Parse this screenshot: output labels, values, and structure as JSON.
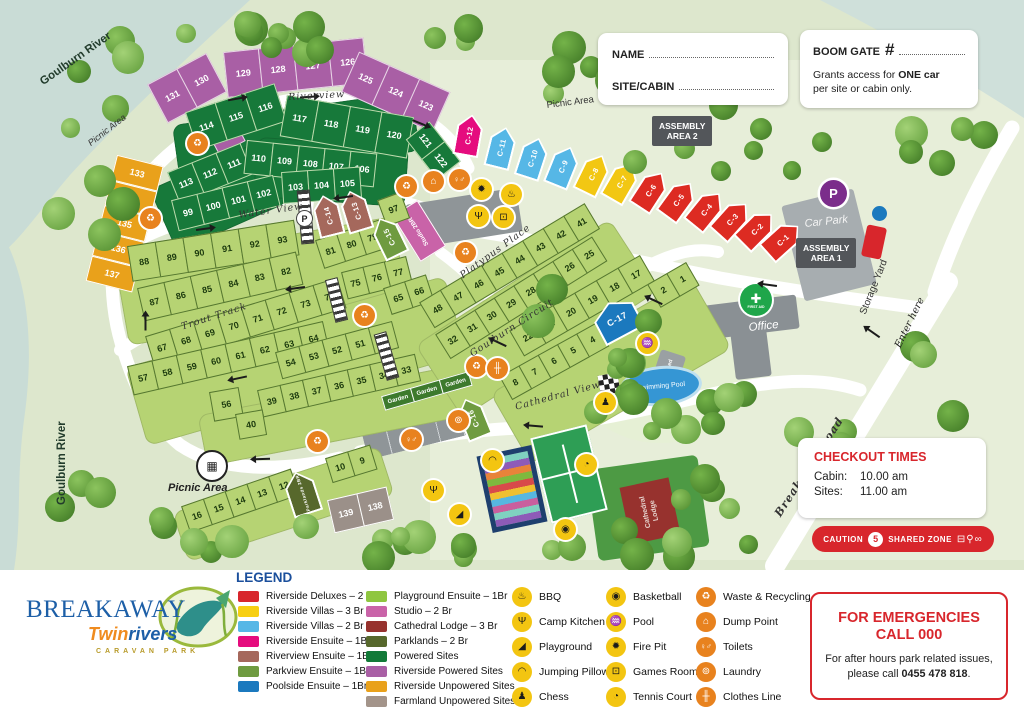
{
  "map": {
    "palette": {
      "lg": {
        "bg": "#b6d373",
        "fg": "#1c3a0e",
        "bd": "#55772f"
      },
      "dg": {
        "bg": "#17793a",
        "fg": "#ffffff",
        "bd": "#bfdcae"
      },
      "pu": {
        "bg": "#a95fa5",
        "fg": "#ffffff",
        "bd": "#e9d7e7"
      },
      "or": {
        "bg": "#e9a11b",
        "fg": "#ffffff",
        "bd": "#ffffff"
      },
      "gy": {
        "bg": "#9b9089",
        "fg": "#ffffff",
        "bd": "#ffffff"
      },
      "gn": {
        "bg": "#3d7a2d",
        "fg": "#ffffff",
        "bd": "#ffffff"
      }
    },
    "labels": {
      "goulburn_river": "Goulburn River",
      "picnic_area": "Picnic Area",
      "assembly": "ASSEMBLY",
      "area1": "AREA 1",
      "area2": "AREA 2",
      "car_park": "Car Park",
      "storage_yard": "Storage Yard",
      "office": "Office",
      "first_aid": "FIRST AID",
      "enter_here": "Enter here",
      "pump_shed": "Pump Shed",
      "swimming_pool": "Swimming Pool",
      "cathedral_1": "Cathedral",
      "cathedral_2": "Lodge",
      "studio": "Studio 2BR",
      "p": "P"
    },
    "streets": {
      "riverview": "Riverview",
      "water_view": "Water View",
      "trout_track": "Trout Track",
      "goulburn_circuit": "Goulburn Circuit",
      "cathedral_view": "Cathedral View",
      "platypus_place": "Platypus Place",
      "breakaway_road": "Breakaway Road"
    },
    "strips": [
      {
        "id": "p1",
        "x": 148,
        "y": 84,
        "rot": -28,
        "cw": 34,
        "ch": 44,
        "k": "pu",
        "nums": [
          131,
          130
        ]
      },
      {
        "id": "p2",
        "x": 224,
        "y": 52,
        "rot": -6,
        "cw": 36,
        "ch": 46,
        "k": "pu",
        "nums": [
          129,
          128,
          127,
          126
        ]
      },
      {
        "id": "p3",
        "x": 360,
        "y": 52,
        "rot": 24,
        "cw": 34,
        "ch": 44,
        "k": "pu",
        "nums": [
          125,
          124,
          123
        ]
      },
      {
        "id": "p4",
        "x": 206,
        "y": 128,
        "rot": -28,
        "cw": 30,
        "ch": 30,
        "k": "pu",
        "nums": [
          132
        ]
      },
      {
        "id": "g1",
        "x": 186,
        "y": 112,
        "rot": -18,
        "cw": 32,
        "ch": 40,
        "k": "dg",
        "nums": [
          114,
          115,
          116
        ]
      },
      {
        "id": "g2",
        "x": 288,
        "y": 95,
        "rot": 10,
        "cw": 33,
        "ch": 42,
        "k": "dg",
        "nums": [
          117,
          118,
          119,
          120
        ]
      },
      {
        "id": "g3",
        "x": 430,
        "y": 122,
        "rot": 52,
        "cw": 26,
        "ch": 30,
        "k": "dg",
        "nums": [
          121,
          122
        ]
      },
      {
        "id": "g4",
        "x": 168,
        "y": 172,
        "rot": -22,
        "cw": 27,
        "ch": 34,
        "k": "dg",
        "nums": [
          113,
          112,
          111
        ]
      },
      {
        "id": "g5",
        "x": 248,
        "y": 140,
        "rot": 6,
        "cw": 27,
        "ch": 34,
        "k": "dg",
        "nums": [
          110,
          109,
          108,
          107,
          106
        ]
      },
      {
        "id": "g6",
        "x": 172,
        "y": 200,
        "rot": -14,
        "cw": 27,
        "ch": 32,
        "k": "dg",
        "nums": [
          99,
          100,
          101,
          102
        ]
      },
      {
        "id": "g7",
        "x": 282,
        "y": 172,
        "rot": -4,
        "cw": 27,
        "ch": 32,
        "k": "dg",
        "nums": [
          103,
          104,
          105
        ]
      },
      {
        "id": "o1",
        "x": 118,
        "y": 155,
        "rot": 14,
        "cw": 48,
        "ch": 26,
        "k": "or",
        "dir": "col",
        "nums": [
          133,
          134,
          135,
          136,
          137
        ]
      },
      {
        "id": "l1",
        "x": 128,
        "y": 246,
        "rot": -9,
        "cw": 29,
        "ch": 36,
        "k": "lg",
        "nums": [
          88,
          89,
          90,
          91,
          92,
          93
        ]
      },
      {
        "id": "l2",
        "x": 316,
        "y": 240,
        "rot": -18,
        "cw": 23,
        "ch": 30,
        "k": "lg",
        "nums": [
          81,
          80,
          79
        ]
      },
      {
        "id": "l3",
        "x": 378,
        "y": 200,
        "rot": -20,
        "cw": 25,
        "ch": 28,
        "k": "lg",
        "nums": [
          97
        ]
      },
      {
        "id": "l4",
        "x": 138,
        "y": 288,
        "rot": -13,
        "cw": 28,
        "ch": 34,
        "k": "lg",
        "nums": [
          87,
          86,
          85,
          84,
          83,
          82
        ]
      },
      {
        "id": "l5",
        "x": 342,
        "y": 272,
        "rot": -14,
        "cw": 23,
        "ch": 28,
        "k": "lg",
        "nums": [
          75,
          76,
          77
        ]
      },
      {
        "id": "l6",
        "x": 146,
        "y": 336,
        "rot": -17,
        "cw": 26,
        "ch": 32,
        "k": "lg",
        "nums": [
          67,
          68,
          69,
          70,
          71,
          72,
          73,
          74
        ]
      },
      {
        "id": "l7",
        "x": 384,
        "y": 288,
        "rot": -18,
        "cw": 23,
        "ch": 28,
        "k": "lg",
        "nums": [
          65,
          66
        ]
      },
      {
        "id": "l8",
        "x": 128,
        "y": 366,
        "rot": -13,
        "cw": 26,
        "ch": 30,
        "k": "lg",
        "nums": [
          57,
          58,
          59,
          60,
          61,
          62,
          63,
          64
        ]
      },
      {
        "id": "l9",
        "x": 276,
        "y": 352,
        "rot": -15,
        "cw": 25,
        "ch": 28,
        "k": "lg",
        "nums": [
          54,
          53,
          52,
          51,
          50
        ]
      },
      {
        "id": "l10",
        "x": 258,
        "y": 390,
        "rot": -13,
        "cw": 24,
        "ch": 28,
        "k": "lg",
        "nums": [
          39,
          38,
          37,
          36,
          35,
          34,
          33
        ]
      },
      {
        "id": "l11",
        "x": 210,
        "y": 392,
        "rot": -10,
        "cw": 30,
        "ch": 30,
        "k": "lg",
        "nums": [
          56
        ]
      },
      {
        "id": "l12",
        "x": 236,
        "y": 414,
        "rot": -10,
        "cw": 28,
        "ch": 26,
        "k": "lg",
        "nums": [
          40
        ]
      },
      {
        "id": "e1",
        "x": 420,
        "y": 302,
        "rot": -31,
        "cw": 25,
        "ch": 30,
        "k": "lg",
        "nums": [
          48,
          47,
          46,
          45,
          44,
          43,
          42,
          41
        ]
      },
      {
        "id": "e2",
        "x": 436,
        "y": 334,
        "rot": -32,
        "cw": 24,
        "ch": 29,
        "k": "lg",
        "nums": [
          32,
          31,
          30,
          29,
          28,
          27,
          26,
          25
        ]
      },
      {
        "id": "e3",
        "x": 510,
        "y": 330,
        "rot": -30,
        "cw": 26,
        "ch": 30,
        "k": "lg",
        "nums": [
          22,
          21,
          20,
          19,
          18,
          17
        ]
      },
      {
        "id": "e4",
        "x": 648,
        "y": 284,
        "rot": -30,
        "cw": 23,
        "ch": 27,
        "k": "lg",
        "nums": [
          2,
          1
        ]
      },
      {
        "id": "e5",
        "x": 500,
        "y": 376,
        "rot": -29,
        "cw": 23,
        "ch": 27,
        "k": "lg",
        "nums": [
          8,
          7,
          6,
          5,
          4
        ]
      },
      {
        "id": "b1",
        "x": 182,
        "y": 506,
        "rot": -19,
        "cw": 24,
        "ch": 28,
        "k": "lg",
        "nums": [
          16,
          15,
          14,
          13,
          12
        ]
      },
      {
        "id": "b2",
        "x": 326,
        "y": 458,
        "rot": -17,
        "cw": 24,
        "ch": 26,
        "k": "lg",
        "nums": [
          10,
          9
        ]
      },
      {
        "id": "f1",
        "x": 328,
        "y": 500,
        "rot": -13,
        "cw": 31,
        "ch": 34,
        "k": "gy",
        "nums": [
          139,
          138
        ]
      },
      {
        "id": "gd",
        "x": 382,
        "y": 396,
        "rot": -16,
        "cw": 31,
        "ch": 15,
        "k": "gn",
        "fs": 6,
        "nums": [
          "Garden",
          "Garden",
          "Garden"
        ]
      }
    ],
    "cabins": [
      {
        "id": "C-12",
        "x": 452,
        "y": 114,
        "rot": 10,
        "c": "#e50c7e"
      },
      {
        "id": "C-11",
        "x": 483,
        "y": 126,
        "rot": 14,
        "c": "#56b7e6"
      },
      {
        "id": "C-10",
        "x": 513,
        "y": 136,
        "rot": 18,
        "c": "#56b7e6"
      },
      {
        "id": "C-9",
        "x": 542,
        "y": 144,
        "rot": 22,
        "c": "#56b7e6"
      },
      {
        "id": "C-8",
        "x": 571,
        "y": 151,
        "rot": 26,
        "c": "#f2c713"
      },
      {
        "id": "C-7",
        "x": 598,
        "y": 158,
        "rot": 30,
        "c": "#f2c713"
      },
      {
        "id": "C-6",
        "x": 626,
        "y": 166,
        "rot": 33,
        "c": "#dd2b22"
      },
      {
        "id": "C-5",
        "x": 653,
        "y": 175,
        "rot": 36,
        "c": "#dd2b22"
      },
      {
        "id": "C-4",
        "x": 680,
        "y": 184,
        "rot": 39,
        "c": "#dd2b22"
      },
      {
        "id": "C-3",
        "x": 705,
        "y": 193,
        "rot": 42,
        "c": "#dd2b22"
      },
      {
        "id": "C-2",
        "x": 729,
        "y": 202,
        "rot": 45,
        "c": "#dd2b22"
      },
      {
        "id": "C-1",
        "x": 754,
        "y": 212,
        "rot": 48,
        "c": "#dd2b22"
      },
      {
        "id": "C-14",
        "x": 320,
        "y": 194,
        "rot": -14,
        "c": "#a5685c"
      },
      {
        "id": "C-13",
        "x": 349,
        "y": 189,
        "rot": -17,
        "c": "#a5685c"
      },
      {
        "id": "C-15",
        "x": 385,
        "y": 214,
        "rot": -26,
        "c": "#6f9b40"
      },
      {
        "id": "C-16",
        "x": 468,
        "y": 396,
        "rot": -22,
        "c": "#6f9b40"
      },
      {
        "id": "C-17",
        "x": 604,
        "y": 298,
        "rot": -28,
        "c": "#1b79be",
        "w": 44,
        "h": 38,
        "hl": true
      },
      {
        "id": "Parklands 2BR",
        "x": 294,
        "y": 470,
        "rot": -18,
        "c": "#57682c",
        "w": 30,
        "h": 44,
        "fs": 4.5
      }
    ],
    "icon_glyphs": {
      "waste": "♻",
      "dump": "⌂",
      "toilets": "♀♂",
      "firepit": "✹",
      "bbq": "♨",
      "campkitchen": "Ψ",
      "gamesroom": "⊡",
      "pool": "♒",
      "chess": "♟",
      "jumpingpillow": "◠",
      "playground": "◢",
      "tennis": "◔",
      "basketball": "◉",
      "laundry": "⊚",
      "clothesline": "╫",
      "picnic": "▦"
    },
    "icon_palette": {
      "waste": "o",
      "dump": "o",
      "toilets": "o",
      "laundry": "o",
      "clothesline": "o",
      "firepit": "y",
      "bbq": "y",
      "campkitchen": "y",
      "gamesroom": "y",
      "pool": "y",
      "chess": "y",
      "jumpingpillow": "y",
      "playground": "y",
      "tennis": "y",
      "basketball": "y",
      "picnic": "y"
    },
    "icons": [
      {
        "t": "waste",
        "x": 197,
        "y": 143
      },
      {
        "t": "waste",
        "x": 150,
        "y": 218
      },
      {
        "t": "waste",
        "x": 406,
        "y": 186
      },
      {
        "t": "dump",
        "x": 433,
        "y": 181
      },
      {
        "t": "toilets",
        "x": 459,
        "y": 179
      },
      {
        "t": "firepit",
        "x": 481,
        "y": 189
      },
      {
        "t": "bbq",
        "x": 511,
        "y": 194
      },
      {
        "t": "campkitchen",
        "x": 478,
        "y": 216
      },
      {
        "t": "gamesroom",
        "x": 503,
        "y": 217
      },
      {
        "t": "waste",
        "x": 465,
        "y": 252
      },
      {
        "t": "waste",
        "x": 364,
        "y": 315
      },
      {
        "t": "waste",
        "x": 476,
        "y": 366
      },
      {
        "t": "clothesline",
        "x": 497,
        "y": 368
      },
      {
        "t": "laundry",
        "x": 458,
        "y": 420
      },
      {
        "t": "toilets",
        "x": 411,
        "y": 439
      },
      {
        "t": "waste",
        "x": 317,
        "y": 441
      },
      {
        "t": "pool",
        "x": 647,
        "y": 343
      },
      {
        "t": "chess",
        "x": 605,
        "y": 402
      },
      {
        "t": "jumpingpillow",
        "x": 492,
        "y": 460
      },
      {
        "t": "campkitchen",
        "x": 433,
        "y": 490
      },
      {
        "t": "playground",
        "x": 459,
        "y": 514
      },
      {
        "t": "tennis",
        "x": 586,
        "y": 464
      },
      {
        "t": "basketball",
        "x": 565,
        "y": 529
      }
    ],
    "arrows": [
      {
        "x": 228,
        "y": 98,
        "r": -10
      },
      {
        "x": 412,
        "y": 122,
        "r": 22
      },
      {
        "x": 196,
        "y": 228,
        "r": -8
      },
      {
        "x": 338,
        "y": 196,
        "r": 172
      },
      {
        "x": 290,
        "y": 287,
        "r": 172
      },
      {
        "x": 138,
        "y": 322,
        "r": -90
      },
      {
        "x": 232,
        "y": 377,
        "r": 168
      },
      {
        "x": 492,
        "y": 342,
        "r": 205
      },
      {
        "x": 528,
        "y": 425,
        "r": 185
      },
      {
        "x": 255,
        "y": 458,
        "r": 178
      },
      {
        "x": 648,
        "y": 300,
        "r": 205
      },
      {
        "x": 866,
        "y": 332,
        "r": 215
      },
      {
        "x": 762,
        "y": 284,
        "r": -172
      },
      {
        "x": 300,
        "y": 96,
        "r": -4
      }
    ],
    "crosswalks": [
      {
        "x": 299,
        "y": 190,
        "w": 11,
        "h": 52,
        "r": -5
      },
      {
        "x": 330,
        "y": 278,
        "w": 11,
        "h": 42,
        "r": -14
      },
      {
        "x": 380,
        "y": 332,
        "w": 11,
        "h": 46,
        "r": -16
      }
    ]
  },
  "forms": {
    "name_label": "NAME",
    "site_label": "SITE/CABIN",
    "boom_label": "BOOM GATE",
    "boom_hash": "#",
    "boom_body_pre": "Grants access for ",
    "boom_body_bold": "ONE car",
    "boom_body_line2": "per site or cabin only."
  },
  "checkout": {
    "title": "CHECKOUT TIMES",
    "cabin_label": "Cabin:",
    "cabin_value": "10.00 am",
    "sites_label": "Sites:",
    "sites_value": "11.00 am"
  },
  "caution": {
    "left": "CAUTION",
    "speed": "5",
    "right": "SHARED ZONE",
    "icons": "⊟⚲∞"
  },
  "emergency": {
    "title1": "FOR EMERGENCIES",
    "title2": "CALL 000",
    "body1": "For after hours park related issues,",
    "body2_pre": "please call ",
    "body2_phone": "0455 478 818",
    "body2_post": "."
  },
  "logo": {
    "line1": "BREAKAWAY",
    "line2_a": "Twin",
    "line2_b": "rivers",
    "line3": "CARAVAN PARK"
  },
  "legend": {
    "title": "LEGEND",
    "site_types_col1": [
      {
        "label": "Riverside Deluxes – 2 Br",
        "color": "#d8262c"
      },
      {
        "label": "Riverside Villas – 3 Br",
        "color": "#f7cf12"
      },
      {
        "label": "Riverside Villas – 2 Br",
        "color": "#56b7e6"
      },
      {
        "label": "Riverside Ensuite – 1Br",
        "color": "#e50c7e"
      },
      {
        "label": "Riverview Ensuite – 1Br",
        "color": "#a5685c"
      },
      {
        "label": "Parkview Ensuite – 1Br",
        "color": "#6f9b40"
      },
      {
        "label": "Poolside Ensuite – 1Br",
        "color": "#1b79be"
      }
    ],
    "site_types_col2": [
      {
        "label": "Playground Ensuite – 1Br",
        "color": "#8fc640"
      },
      {
        "label": "Studio – 2 Br",
        "color": "#c963a8"
      },
      {
        "label": "Cathedral Lodge – 3 Br",
        "color": "#97322e"
      },
      {
        "label": "Parklands – 2 Br",
        "color": "#57682c"
      },
      {
        "label": "Powered Sites",
        "color": "#127a38"
      },
      {
        "label": "Riverside Powered Sites",
        "color": "#a95fa5"
      },
      {
        "label": "Riverside Unpowered Sites",
        "color": "#e9a11b"
      },
      {
        "label": "Farmland Unpowered Sites",
        "color": "#a3948a"
      }
    ],
    "amenities_col1": [
      {
        "t": "bbq",
        "label": "BBQ"
      },
      {
        "t": "campkitchen",
        "label": "Camp Kitchen"
      },
      {
        "t": "playground",
        "label": "Playground"
      },
      {
        "t": "jumpingpillow",
        "label": "Jumping Pillow"
      },
      {
        "t": "chess",
        "label": "Chess"
      }
    ],
    "amenities_col2": [
      {
        "t": "basketball",
        "label": "Basketball"
      },
      {
        "t": "pool",
        "label": "Pool"
      },
      {
        "t": "firepit",
        "label": "Fire Pit"
      },
      {
        "t": "gamesroom",
        "label": "Games Room"
      },
      {
        "t": "tennis",
        "label": "Tennis Court"
      }
    ],
    "amenities_col3": [
      {
        "t": "waste",
        "label": "Waste & Recycling"
      },
      {
        "t": "dump",
        "label": "Dump Point"
      },
      {
        "t": "toilets",
        "label": "Toilets"
      },
      {
        "t": "laundry",
        "label": "Laundry"
      },
      {
        "t": "clothesline",
        "label": "Clothes Line"
      }
    ]
  }
}
